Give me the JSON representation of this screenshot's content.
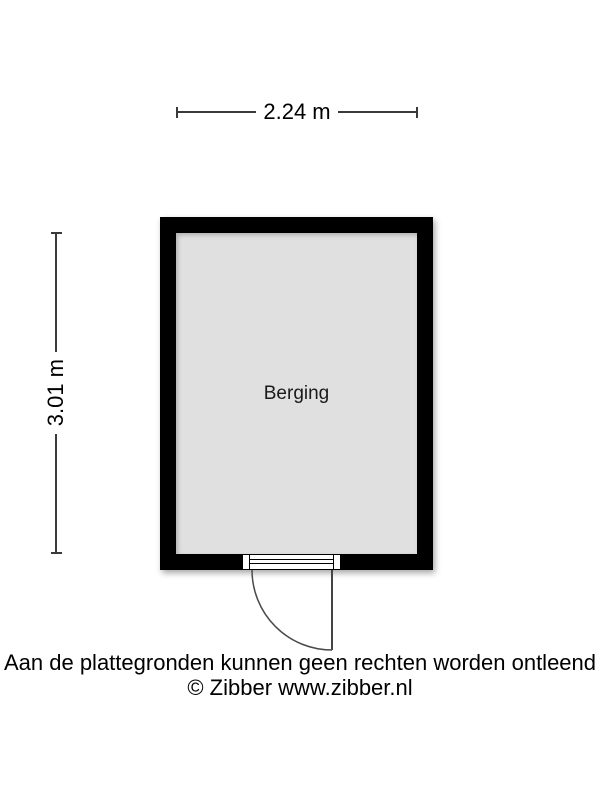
{
  "floorplan": {
    "room": {
      "label": "Berging"
    },
    "dimensions": {
      "width_label": "2.24 m",
      "height_label": "3.01 m"
    }
  },
  "footer": {
    "disclaimer": "Aan de plattegronden kunnen geen rechten worden ontleend",
    "copyright": "© Zibber www.zibber.nl"
  },
  "colors": {
    "wall": "#000000",
    "room_fill": "#e0e0e0",
    "dim_line": "#3a3a3a",
    "background": "#ffffff"
  }
}
